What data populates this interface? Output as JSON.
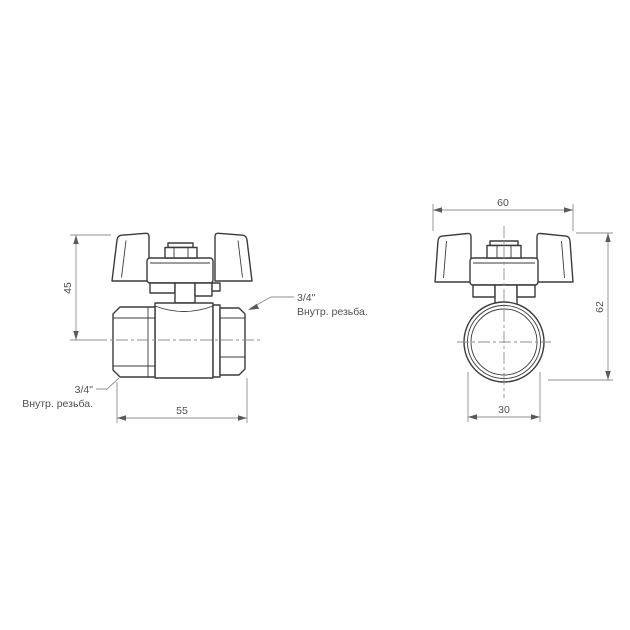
{
  "drawing": {
    "kind": "technical-drawing",
    "subject": "Ball valve with butterfly handle, two orthographic views (side and front)",
    "views": [
      "side-view",
      "front-view"
    ]
  },
  "dims": {
    "side_height": "45",
    "side_length": "55",
    "front_width": "60",
    "front_height": "62",
    "front_bore": "30"
  },
  "labels": {
    "left_thread": {
      "line1": "3/4\"",
      "line2": "Внутр. резьба."
    },
    "right_thread": {
      "line1": "3/4\"",
      "line2": "Внутр. резьба."
    }
  },
  "colors": {
    "background": "#ffffff",
    "outline": "#3b3b3b",
    "thin": "#8f8f8f",
    "text": "#4f4f4f",
    "arrow": "#5a5a5a"
  }
}
